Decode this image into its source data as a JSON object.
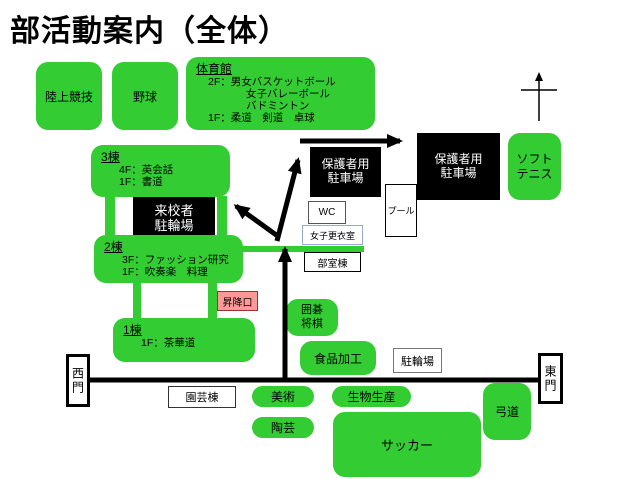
{
  "title": "部活動案内（全体）",
  "colors": {
    "club_green": "#33cc33",
    "facility_black": "#000000",
    "entrance_pink_fill": "#ff9999",
    "entrance_pink_border": "#993333",
    "locker_border_blue": "#99aacc",
    "road_black": "#000000"
  },
  "club_areas": {
    "track_field": {
      "label": "陸上競技"
    },
    "baseball": {
      "label": "野球"
    },
    "gym": {
      "title": "体育館",
      "lines": [
        "2F：男女バスケットボール",
        "女子バレーボール",
        "バドミントン",
        "1F：柔道　剣道　卓球"
      ]
    },
    "building3": {
      "title": "3棟",
      "lines": [
        "4F：英会話",
        "1F：書道"
      ]
    },
    "building2": {
      "title": "2棟",
      "lines": [
        "3F：ファッション研究",
        "1F：吹奏楽　料理"
      ]
    },
    "building1": {
      "title": "1棟",
      "lines": [
        "1F：茶華道"
      ]
    },
    "soft_tennis": {
      "line1": "ソフト",
      "line2": "テニス"
    },
    "igo_shogi": {
      "line1": "囲碁",
      "line2": "将棋"
    },
    "food_processing": {
      "label": "食品加工"
    },
    "art": {
      "label": "美術"
    },
    "pottery": {
      "label": "陶芸"
    },
    "bio_production": {
      "label": "生物生産"
    },
    "soccer": {
      "label": "サッカー"
    },
    "kyudo": {
      "label": "弓道"
    }
  },
  "facilities": {
    "visitor_bicycle": {
      "line1": "来校者",
      "line2": "駐輪場"
    },
    "parent_parking_1": {
      "line1": "保護者用",
      "line2": "駐車場"
    },
    "parent_parking_2": {
      "line1": "保護者用",
      "line2": "駐車場"
    },
    "wc": {
      "label": "WC"
    },
    "girls_locker": {
      "label": "女子更衣室"
    },
    "club_room_bldg": {
      "label": "部室棟"
    },
    "pool": {
      "label": "プール"
    },
    "bicycle_parking": {
      "label": "駐輪場"
    },
    "gardening_bldg": {
      "label": "園芸棟"
    },
    "entrance": {
      "label": "昇降口"
    },
    "west_gate": {
      "label": "西門"
    },
    "east_gate": {
      "label": "東門"
    }
  }
}
